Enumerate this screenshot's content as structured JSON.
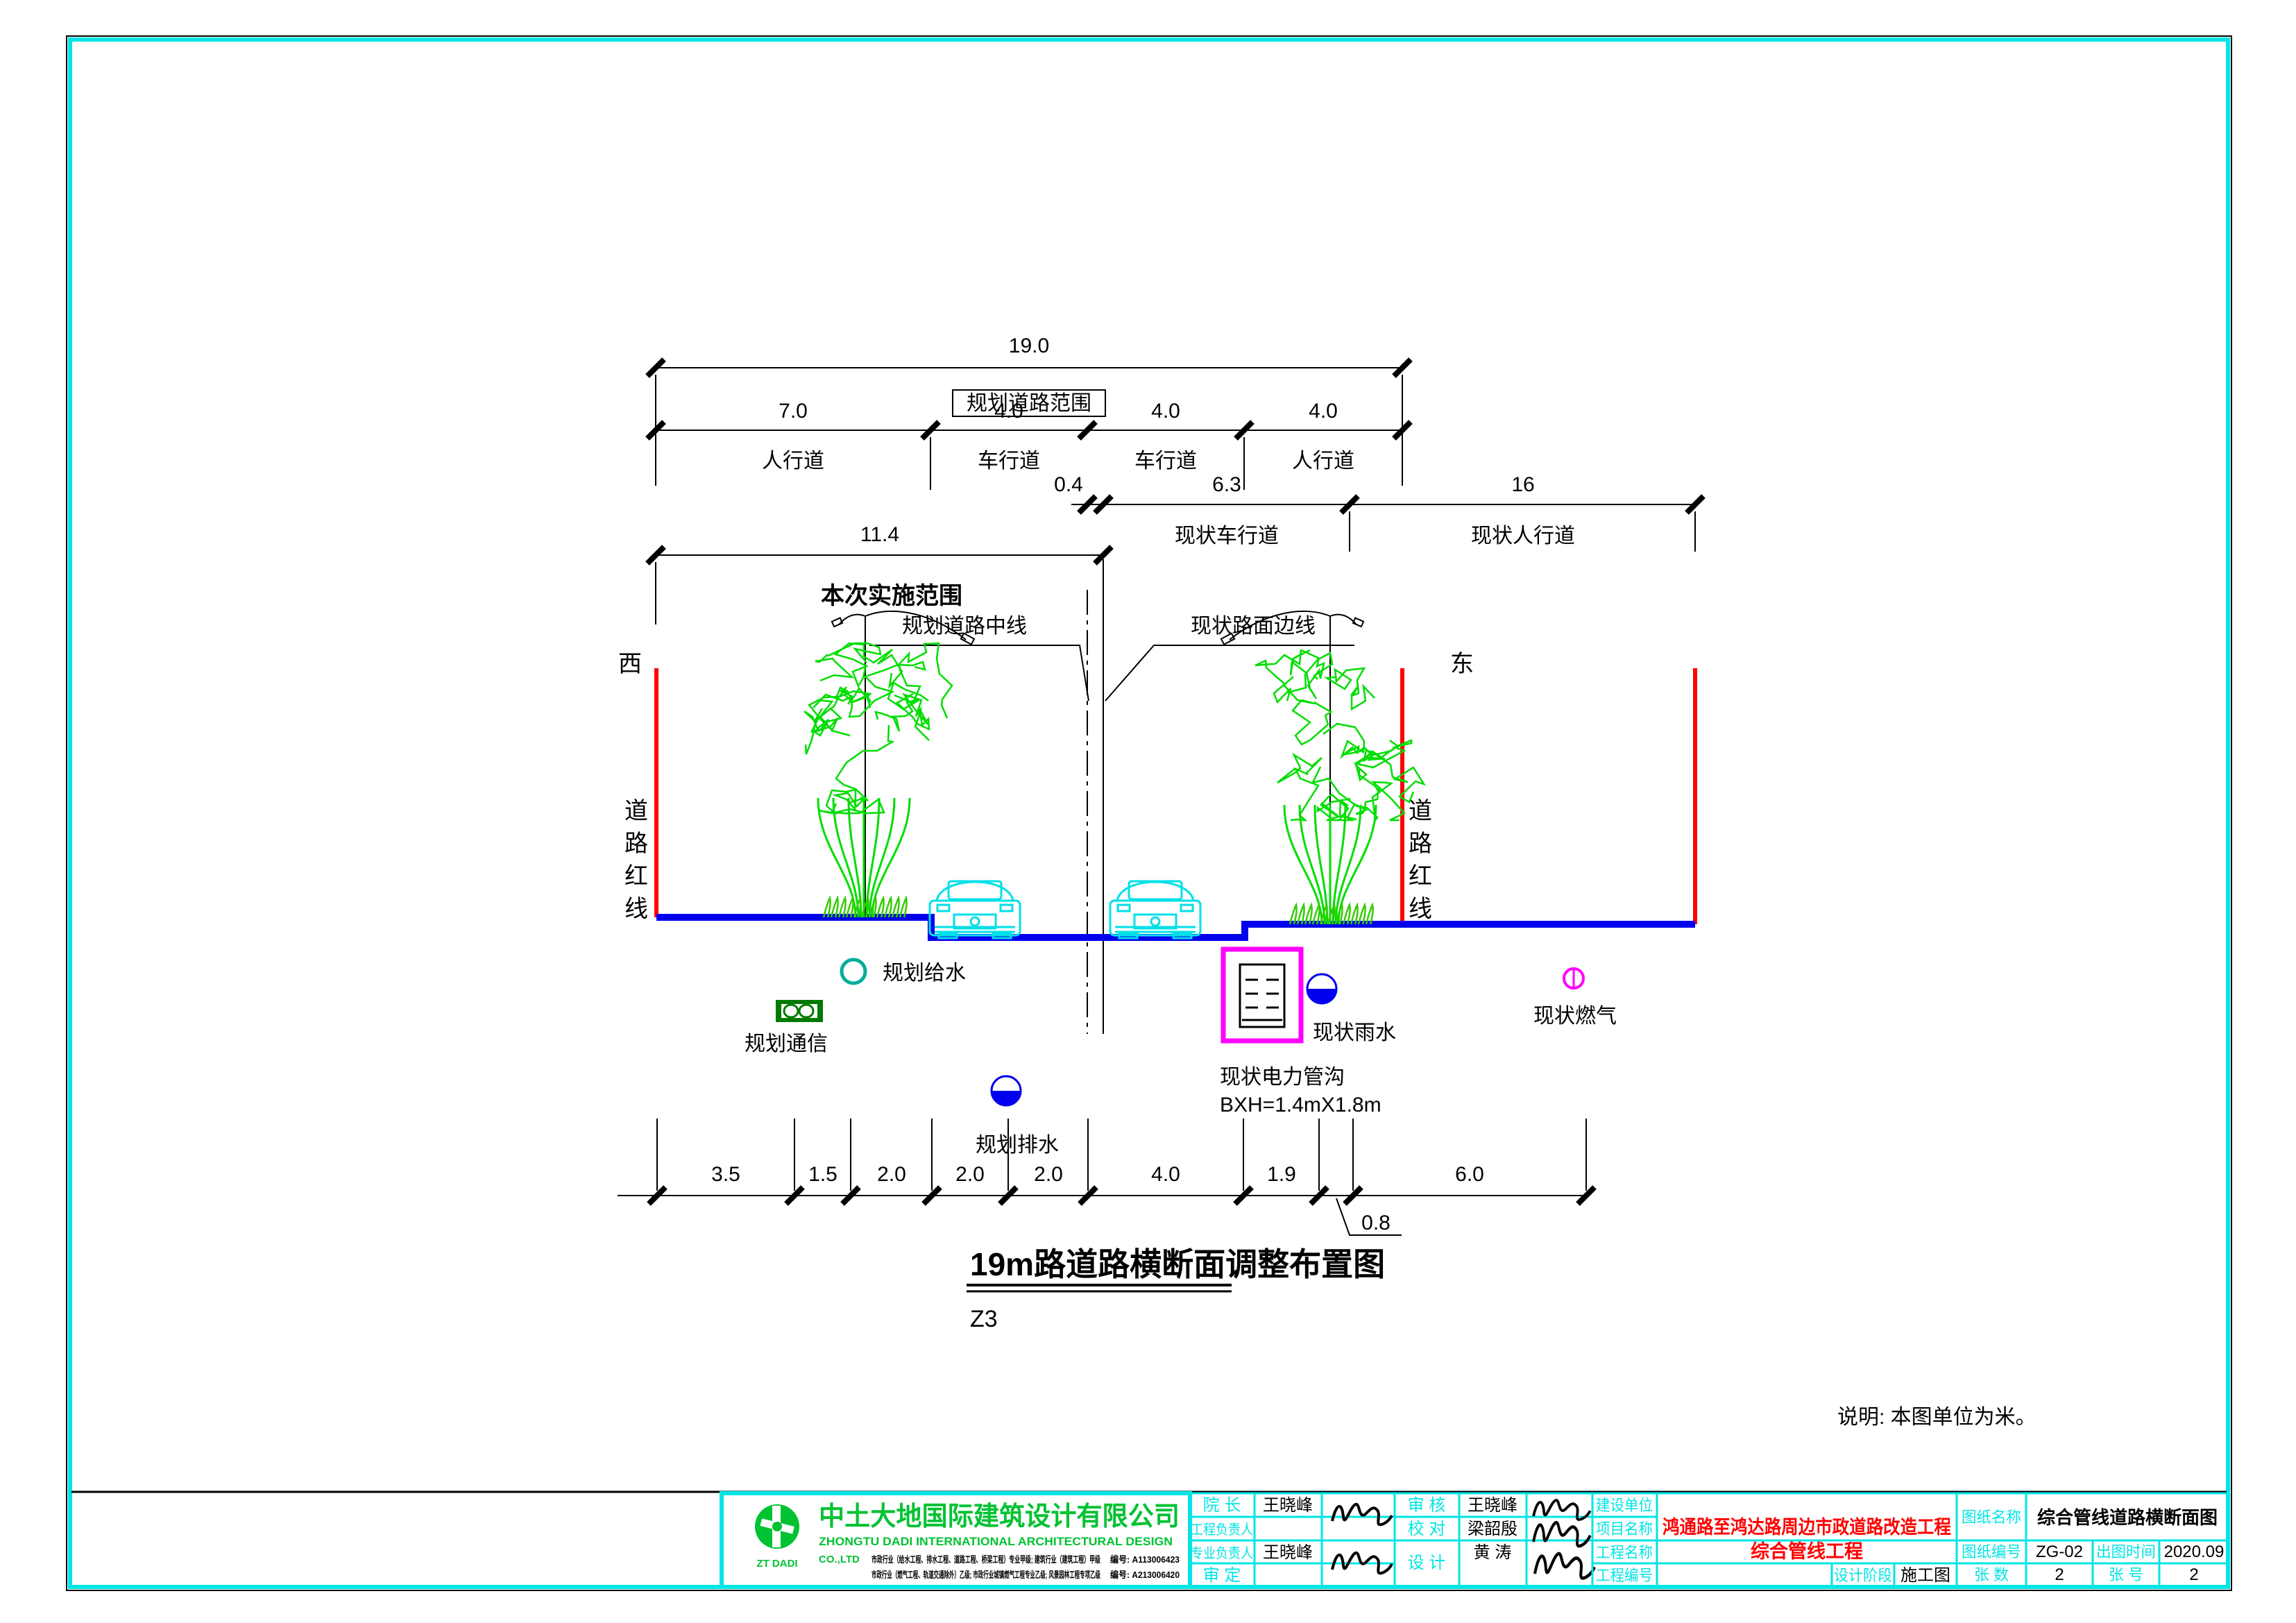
{
  "colors": {
    "frame": "#00ffff",
    "red_line": "#ff0000",
    "road_blue": "#0000ee",
    "tree_green": "#00dd00",
    "car_cyan": "#00e5ee",
    "magenta": "#ff00ff",
    "teal_water": "#00ae9a",
    "comm_green": "#007a00",
    "company_green": "#00c232",
    "table_cyan": "#00e5e5",
    "value_red": "#ff0000"
  },
  "dims": {
    "overall": {
      "value": "19.0",
      "label": "规划道路范围"
    },
    "planned": {
      "values": [
        "7.0",
        "4.0",
        "4.0",
        "4.0"
      ],
      "labels": [
        "人行道",
        "车行道",
        "车行道",
        "人行道"
      ]
    },
    "existing": {
      "values": [
        "0.4",
        "6.3",
        "16"
      ],
      "labels": [
        "现状车行道",
        "现状人行道"
      ]
    },
    "implement": {
      "value": "11.4",
      "label": "本次实施范围"
    },
    "bottom": {
      "values": [
        "3.5",
        "1.5",
        "2.0",
        "2.0",
        "2.0",
        "4.0",
        "1.9",
        "6.0"
      ],
      "offset": "0.8"
    }
  },
  "annotations": {
    "planned_centerline": "规划道路中线",
    "existing_edge": "现状路面边线",
    "west": "西",
    "east": "东",
    "redline": "道路红线"
  },
  "utilities": {
    "water": "规划给水",
    "comm": "规划通信",
    "drain": "规划排水",
    "rain": "现状雨水",
    "power": "现状电力管沟",
    "power_size": "BXH=1.4mX1.8m",
    "gas": "现状燃气"
  },
  "caption": {
    "title": "19m路道路横断面调整布置图",
    "tag": "Z3",
    "note": "说明: 本图单位为米。"
  },
  "company": {
    "logo_text": "ZT DADI",
    "name_cn": "中土大地国际建筑设计有限公司",
    "name_en": "ZHONGTU DADI INTERNATIONAL ARCHITECTURAL DESIGN",
    "name_en2": "CO.,LTD",
    "cred1": "市政行业（给水工程、排水工程、道路工程、桥梁工程）专业甲级; 建筑行业（建筑工程）甲级",
    "cred1_no": "编号: A113006423",
    "cred2": "市政行业（燃气工程、轨道交通除外）乙级; 市政行业城镇燃气工程专业乙级; 风景园林工程专项乙级",
    "cred2_no": "编号: A213006420"
  },
  "approvals": {
    "director_label": "院 长",
    "director": "王晓峰",
    "pm_label": "工程负责人",
    "pm": "",
    "lead_label": "专业负责人",
    "lead": "王晓峰",
    "approve_label": "审 定",
    "approve": "",
    "review_label": "审 核",
    "review": "王晓峰",
    "check_label": "校 对",
    "check": "梁韶殷",
    "design_label": "设 计",
    "design": "黄 涛"
  },
  "project": {
    "owner_label": "建设单位",
    "owner": "",
    "project_label": "项目名称",
    "project": "鸿通路至鸿达路周边市政道路改造工程",
    "works_label": "工程名称",
    "works": "综合管线工程",
    "no_label": "工程编号",
    "no": "",
    "stage_label": "设计阶段",
    "stage": "施工图"
  },
  "drawing": {
    "name_label": "图纸名称",
    "name": "综合管线道路横断面图",
    "no_label": "图纸编号",
    "no": "ZG-02",
    "date_label": "出图时间",
    "date": "2020.09",
    "sheets_label": "张 数",
    "sheets": "2",
    "sheetno_label": "张 号",
    "sheetno": "2"
  }
}
